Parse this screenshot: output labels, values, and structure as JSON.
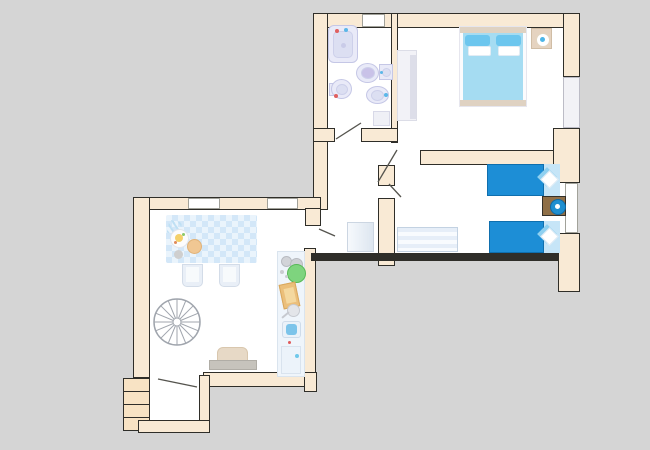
{
  "title": "apartment floor plan",
  "canvas": {
    "width": 650,
    "height": 450,
    "background": "#d5d5d5"
  },
  "palette": {
    "wall_fill": "#f9ead5",
    "wall_outline": "#2f2e29",
    "floor": "#ffffff",
    "step_fill": "#f8e3c4",
    "fixture_lavender": "#e9eaf8",
    "fixture_outline": "#c5c7e6",
    "double_bed_blue": "#a5dcf2",
    "pillow_blue": "#6cc6ee",
    "twin_bed_blue": "#1d8ed6",
    "pillow_panel_blue": "#c6e5f7",
    "nightstand_brown": "#8f6f47",
    "lamp_blue": "#1f8fd0",
    "headboard_tan": "#dfd2c2",
    "tablecloth_check_blue": "#d3e7f8",
    "counter_fill": "#eff5fb",
    "plant_green": "#7ed47e",
    "cutting_board_tan": "#ecc17c",
    "sofa_tan": "#e7d9c6",
    "dresser_stripe_blue": "#e6eef8",
    "stair_line_gray": "#a0a5ad",
    "door_line": "#55544e",
    "window_glass": "#f2f2f6"
  },
  "rooms": {
    "bathroom": {
      "name": "bathroom",
      "fixtures": [
        "bathtub",
        "washbasin",
        "toilet",
        "bidet",
        "wall sink",
        "shower mat"
      ]
    },
    "double_bedroom": {
      "name": "double bedroom",
      "furniture": [
        "double bed",
        "wardrobe",
        "nightstand with lamp"
      ]
    },
    "twin_bedroom": {
      "name": "twin bedroom",
      "furniture": [
        "single bed",
        "single bed",
        "nightstand with lamp",
        "dresser"
      ]
    },
    "living_room": {
      "name": "living room with kitchenette",
      "furniture": [
        "dining table",
        "chair",
        "chair",
        "spiral staircase",
        "kitchen counter",
        "sofa"
      ]
    },
    "hallway": {
      "name": "hallway",
      "furniture": [
        "radiator"
      ]
    },
    "entry": {
      "name": "entry vestibule",
      "features": [
        "external steps",
        "entrance door"
      ]
    }
  }
}
